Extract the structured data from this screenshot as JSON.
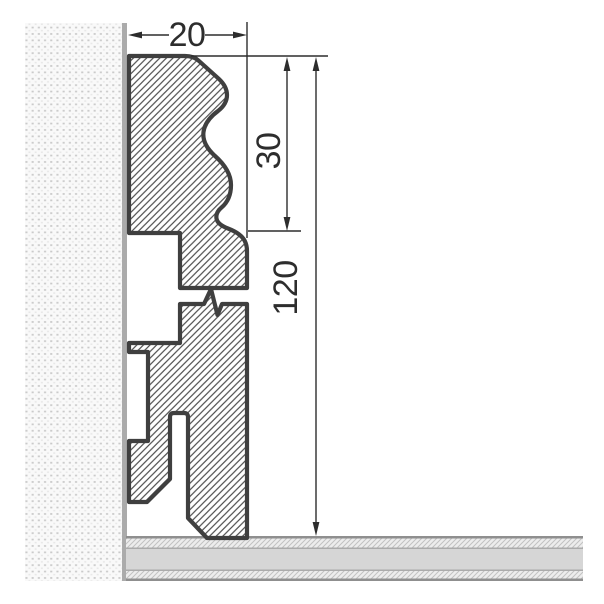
{
  "drawing": {
    "title": "skirting-board-profile-cross-section",
    "labels": {
      "width": "20",
      "upper_section_height": "30",
      "total_height": "120"
    },
    "components": {
      "wall": "stippled-wall-section",
      "floor": "layered-floor-section",
      "profile": "hatched-skirting-profile",
      "break": "zigzag-break-symbol"
    }
  },
  "colors": {
    "outline": "#3f3f3f",
    "hatch": "#4e4e4e",
    "dim-text": "#2d2d2d",
    "dim-line": "#2d2d2d",
    "wall-bg": "#f9f9f9",
    "wall-dot": "#c9c9c9",
    "wall-dot-light": "#e7e7e7",
    "wall-edge": "#ababab",
    "floor-border": "#8f8f8f",
    "floor-divider": "#ababab",
    "floor-mid": "#d6d6d6",
    "floor-hatch-bg": "#ededed",
    "floor-hatch-line": "#c2c2c2",
    "paper": "#ffffff"
  }
}
